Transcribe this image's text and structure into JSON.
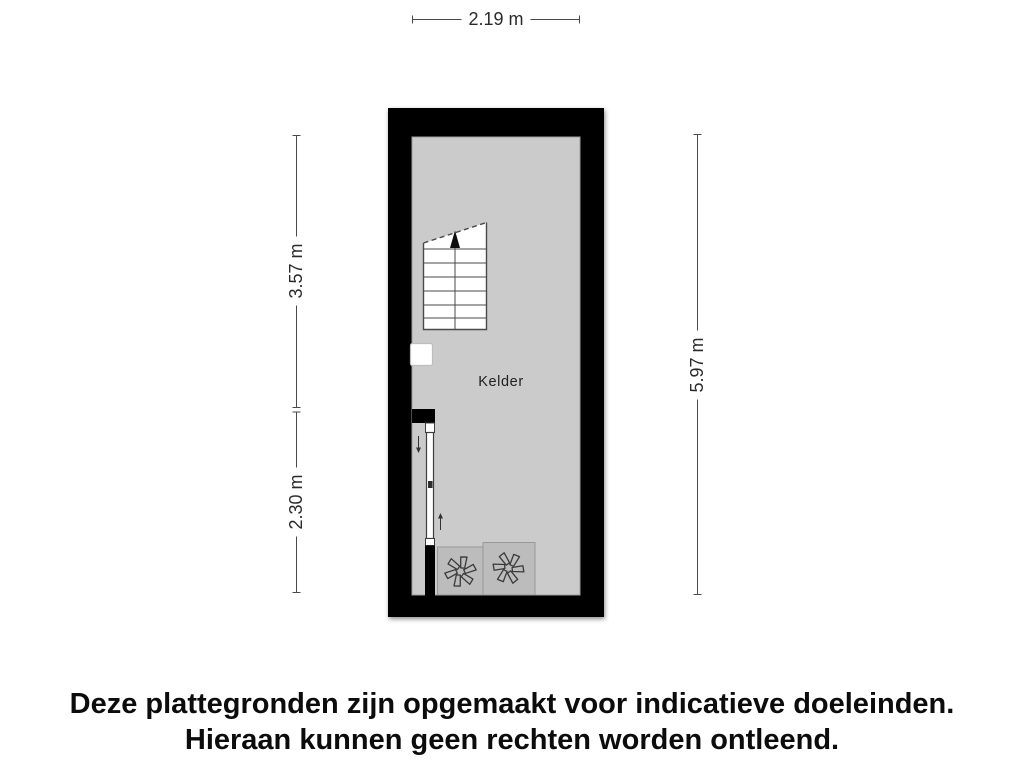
{
  "floorplan": {
    "room_label": "Kelder",
    "dimensions": {
      "top": "2.19 m",
      "left_upper": "3.57 m",
      "left_lower": "2.30 m",
      "right": "5.97 m"
    },
    "colors": {
      "wall": "#000000",
      "floor": "#cbcbcb",
      "appliance_box": "#bcbcbc",
      "stair_fill": "#ffffff",
      "dimension_line": "#4a4a4a"
    },
    "icons": {
      "stair_direction": "up-arrow-icon",
      "ladder_top": "down-arrow-icon",
      "ladder_bottom": "up-arrow-icon",
      "appliances": [
        "fan-icon",
        "fan-icon"
      ]
    }
  },
  "footer": {
    "line1": "Deze plattegronden zijn opgemaakt voor indicatieve doeleinden.",
    "line2": "Hieraan kunnen geen rechten worden ontleend."
  }
}
